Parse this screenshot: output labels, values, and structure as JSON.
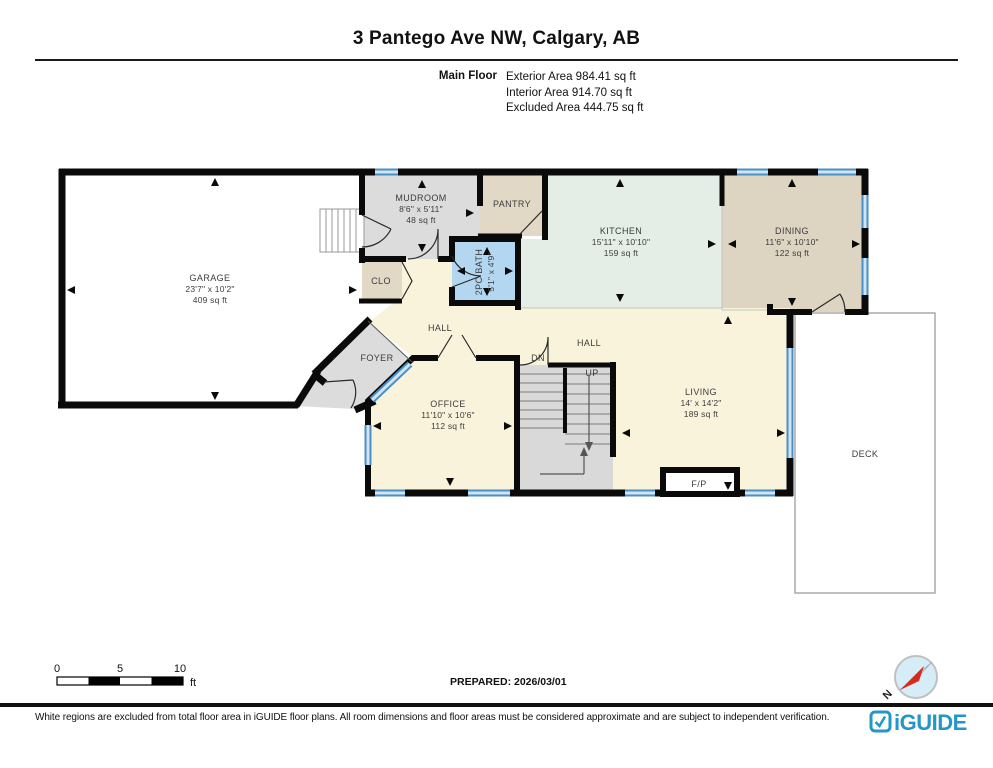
{
  "header": {
    "title": "3 Pantego Ave NW, Calgary, AB",
    "floor_label": "Main Floor",
    "stats": [
      "Exterior Area 984.41 sq ft",
      "Interior Area 914.70 sq ft",
      "Excluded Area 444.75 sq ft"
    ]
  },
  "rooms": {
    "garage": {
      "name": "GARAGE",
      "dims": "23'7\" x 10'2\"",
      "area": "409 sq ft"
    },
    "mudroom": {
      "name": "MUDROOM",
      "dims": "8'6\" x 5'11\"",
      "area": "48 sq ft"
    },
    "pantry": {
      "name": "PANTRY"
    },
    "closet": {
      "name": "CLO"
    },
    "bath": {
      "name": "2PC BATH",
      "dims": "5'1\" x 4'9\""
    },
    "kitchen": {
      "name": "KITCHEN",
      "dims": "15'11\" x 10'10\"",
      "area": "159 sq ft"
    },
    "dining": {
      "name": "DINING",
      "dims": "11'6\" x 10'10\"",
      "area": "122 sq ft"
    },
    "hall_upper": {
      "name": "HALL"
    },
    "hall_main": {
      "name": "HALL"
    },
    "foyer": {
      "name": "FOYER"
    },
    "office": {
      "name": "OFFICE",
      "dims": "11'10\" x 10'6\"",
      "area": "112 sq ft"
    },
    "living": {
      "name": "LIVING",
      "dims": "14' x 14'2\"",
      "area": "189 sq ft"
    },
    "deck": {
      "name": "DECK"
    },
    "fireplace": {
      "name": "F/P"
    },
    "stairs": {
      "up": "UP",
      "down": "DN"
    }
  },
  "scale_bar": {
    "labels": [
      "0",
      "5",
      "10"
    ],
    "unit": "ft"
  },
  "compass": {
    "north_label": "N"
  },
  "footer": {
    "prepared": "PREPARED: 2026/03/01",
    "disclaimer": "White regions are excluded from total floor area in iGUIDE floor plans. All room dimensions and floor areas must be considered approximate and are subject to independent verification.",
    "brand": "iGUIDE"
  },
  "colors": {
    "wall": "#0a0a0a",
    "window_blue": "#4a90c4",
    "room_gray": "#dcdcdc",
    "room_tan": "#e2d8c6",
    "room_mint": "#e4ede6",
    "room_cream": "#faf3dc",
    "room_bath_blue": "#b3d7f0",
    "brand_blue": "#2596c8"
  }
}
